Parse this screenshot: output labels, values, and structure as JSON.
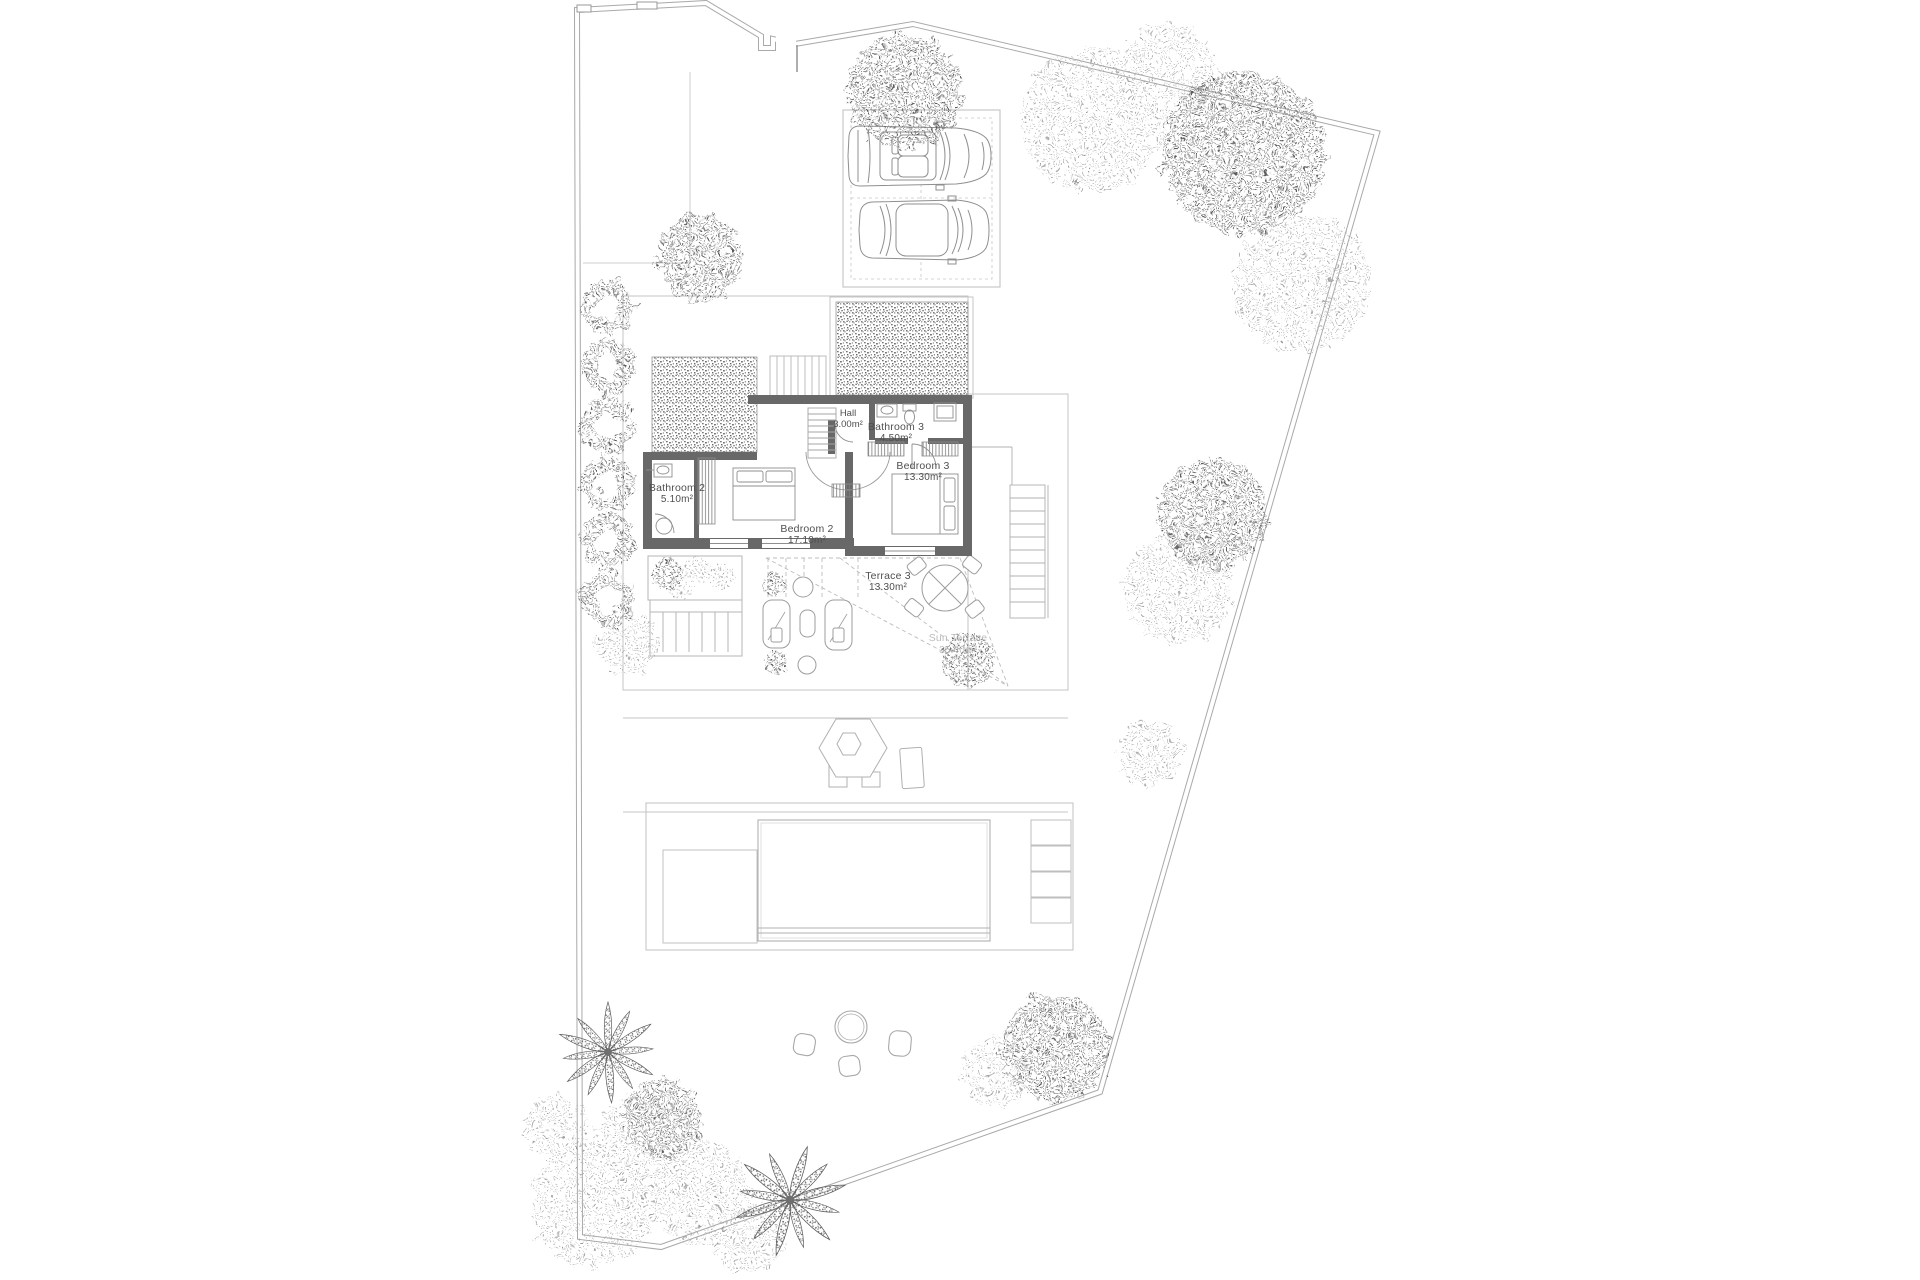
{
  "plan": {
    "title": "Villa site plan – first floor",
    "rooms": [
      {
        "name": "Hall",
        "area": "3.00m²"
      },
      {
        "name": "Bathroom 3",
        "area": "4.50m²"
      },
      {
        "name": "Bedroom 3",
        "area": "13.30m²"
      },
      {
        "name": "Bathroom 2",
        "area": "5.10m²"
      },
      {
        "name": "Bedroom 2",
        "area": "17.10m²"
      },
      {
        "name": "Terrace 3",
        "area": "13.30m²"
      },
      {
        "name": "Sun Terrace",
        "area": "35.40m²"
      }
    ],
    "features": [
      "plot-boundary",
      "entrance-gate",
      "driveway",
      "carport",
      "car",
      "green-roof",
      "roof-stair",
      "interior-stair",
      "exterior-stair",
      "planter",
      "trellis-deck",
      "sun-loungers",
      "dining-table",
      "pergola-parasol",
      "pool",
      "pool-deck",
      "pool-steps",
      "stepping-stones",
      "hedge-row",
      "trees",
      "palm-trees"
    ],
    "colors": {
      "background": "#ffffff",
      "wall": "#686868",
      "line": "#9b9b9b",
      "faint_line": "#c9c9c9",
      "boundary": "#a9a9a9",
      "label": "#4f4f4f",
      "label_light": "#bcbcbc",
      "vegetation_dark": "#6f6f6f",
      "vegetation_light": "#a8a8a8"
    }
  }
}
